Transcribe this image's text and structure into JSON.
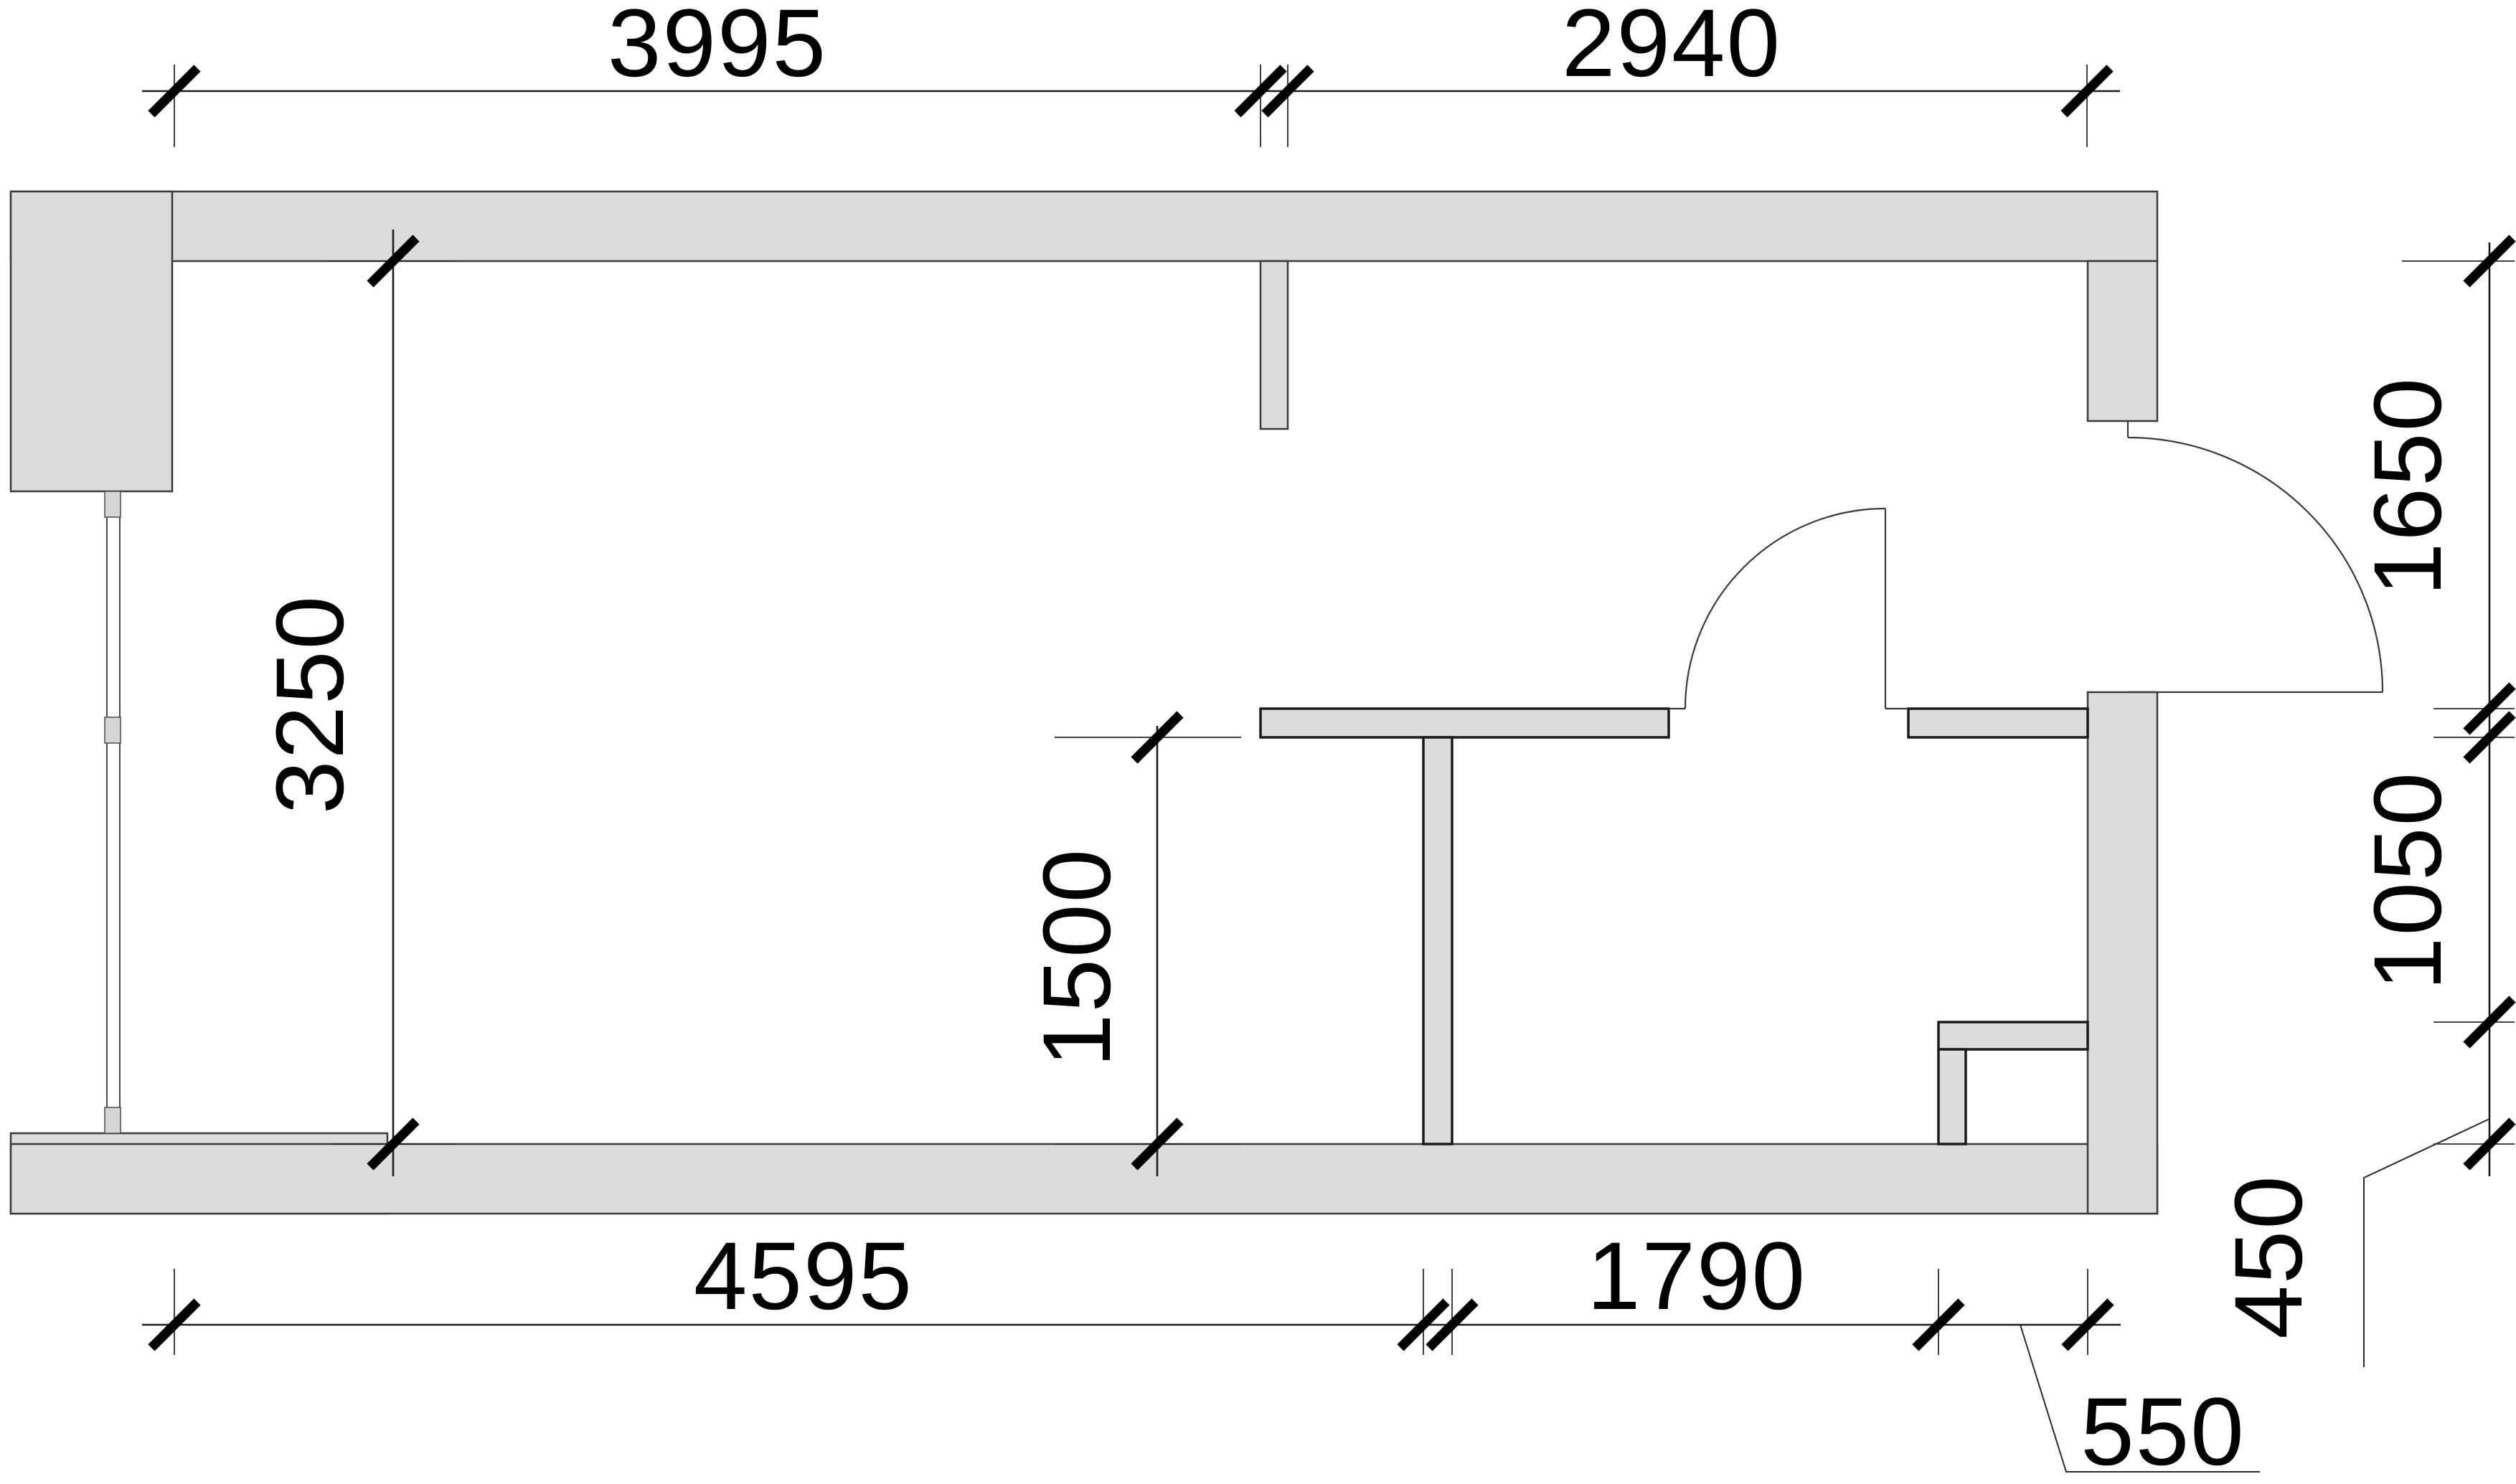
{
  "page": {
    "title": "Apartment floor plan drawing"
  },
  "colors": {
    "background": "#ffffff",
    "wall_fill": "#dcdcdc",
    "wall_outline": "#3a3a3a",
    "detail_outline": "#1a1a1a",
    "dim_line": "#1c1c1c",
    "text": "#000000"
  },
  "dims": {
    "top_left": "3995",
    "top_right": "2940",
    "left_interior": "3250",
    "room_interior": "1500",
    "right_top": "1650",
    "right_middle": "1050",
    "right_bottom": "450",
    "bottom_left": "4595",
    "bottom_middle": "1790",
    "bottom_right": "550"
  }
}
